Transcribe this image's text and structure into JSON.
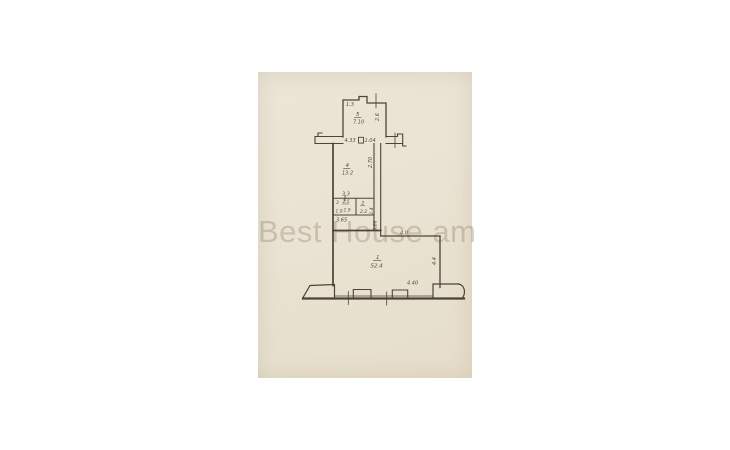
{
  "watermark": "Best House am",
  "colors": {
    "paper": "#eae3d3",
    "ink": "#4d4336",
    "watermark": "rgba(148,136,114,0.38)"
  },
  "rooms": {
    "r5": {
      "num": "5",
      "area": "7.10"
    },
    "r4": {
      "num": "4",
      "area": "13.2"
    },
    "r3": {
      "num": "3",
      "area": "1.5"
    },
    "r2": {
      "num": "2",
      "area": "2.2"
    },
    "r1": {
      "num": "1",
      "area": "52.4"
    }
  },
  "dims": {
    "d13": "1.3",
    "d26": "2.6",
    "d433": "4.33",
    "d104": "1.04",
    "d270": "2.70",
    "d33": "3.3",
    "d10": "1.0",
    "d19": "1.9",
    "d14": "1.4",
    "d365": "3.65",
    "d066": "0.66",
    "d40": "4.0",
    "d44": "4.4",
    "d440": "4.40"
  }
}
